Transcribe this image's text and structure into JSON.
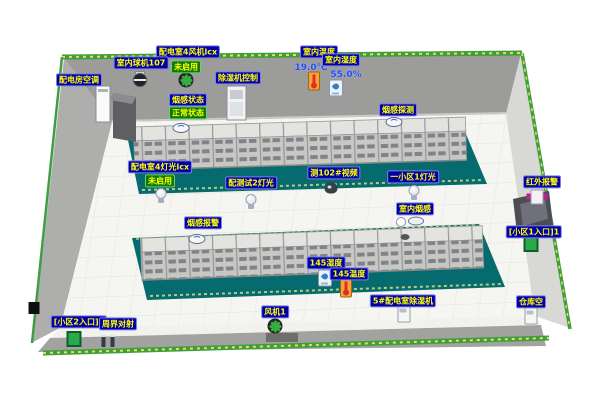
{
  "labels": {
    "room_fan4": "配电室4风机lcx",
    "dome_cam107": "室内球机107",
    "room_ac": "配电房空调",
    "dehumid_ctrl": "除湿机控制",
    "indoor_temp": "室内温度",
    "indoor_hum": "室内湿度",
    "smoke_status": "烟感状态",
    "smoke_detect": "烟感探测",
    "lights4": "配电室4灯光lcx",
    "lights_test2": "配测试2灯光",
    "video102": "测102#视频",
    "area1_light": "一小区1灯光",
    "indoor_smoke": "室内烟感",
    "smoke_alarm": "烟感报警",
    "hum145": "145湿度",
    "temp145": "145温度",
    "dehumid5": "5#配电室除湿机",
    "warehouse_ac": "仓库空",
    "fan1": "风机1",
    "ir_alarm": "红外报警",
    "entrance1": "[小区1入口]1",
    "entrance2": "[小区2入口]2",
    "perimeter": "周界对射"
  },
  "statuses": {
    "fan4": "未启用",
    "smoke": "正常状态",
    "lights4": "未启用"
  },
  "values": {
    "indoor_temp": "19.0℃",
    "indoor_humidity": "55.0%"
  },
  "icons": {
    "fan": "fan-icon",
    "bulb": "bulb-icon",
    "ptz_camera": "ptz-camera-icon",
    "dome_camera": "dome-camera-icon",
    "thermometer": "thermometer-icon",
    "humidity": "humidity-icon",
    "smoke_detector": "smoke-detector-icon",
    "infrared_sensor": "infrared-sensor-icon",
    "entrance_marker": "entrance-marker-icon",
    "perimeter_beams": "beam-posts-icon",
    "appliance": "appliance-icon"
  },
  "colors": {
    "label_bg": "#0000a6",
    "label_text": "#ffff00",
    "status_bg": "#0a7a0a",
    "value_text": "#1e49ff",
    "platform": "#056b6e",
    "wall": "#9c9c9a",
    "floor": "#f5f5f2",
    "greenbelt": "#3f9d42",
    "cabinet": "#c7c7c4"
  }
}
